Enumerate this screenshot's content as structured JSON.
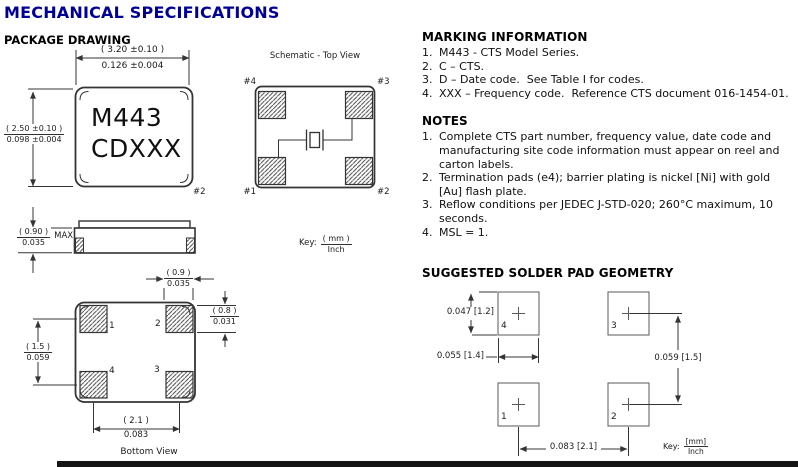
{
  "page": {
    "title": "MECHANICAL SPECIFICATIONS"
  },
  "package_drawing": {
    "heading": "PACKAGE DRAWING",
    "top_view": {
      "width_mm": "( 3.20 ±0.10 )",
      "width_in": "0.126 ±0.004",
      "height_mm": "( 2.50 ±0.10 )",
      "height_in": "0.098 ±0.004",
      "marking_line1": "M443",
      "marking_line2": "CDXXX",
      "pin2": "#2"
    },
    "side_view": {
      "height_mm": "( 0.90 )",
      "height_in": "0.035",
      "qualifier": "MAX"
    },
    "bottom_view": {
      "label": "Bottom View",
      "pad_width_mm": "( 0.9 )",
      "pad_width_in": "0.035",
      "pad_height_mm": "( 0.8 )",
      "pad_height_in": "0.031",
      "row_pitch_mm": "( 1.5 )",
      "row_pitch_in": "0.059",
      "col_pitch_mm": "( 2.1 )",
      "col_pitch_in": "0.083",
      "pad1": "1",
      "pad2": "2",
      "pad3": "3",
      "pad4": "4"
    },
    "schematic": {
      "title": "Schematic - Top View",
      "pin1": "#1",
      "pin2": "#2",
      "pin3": "#3",
      "pin4": "#4",
      "key_label": "Key:",
      "key_top": "( mm )",
      "key_bottom": "Inch"
    }
  },
  "marking_information": {
    "heading": "MARKING INFORMATION",
    "items": [
      {
        "num": "1.",
        "text": "M443 - CTS Model Series."
      },
      {
        "num": "2.",
        "text": "C – CTS."
      },
      {
        "num": "3.",
        "text": "D – Date code.  See Table I for codes."
      },
      {
        "num": "4.",
        "text": "XXX – Frequency code.  Reference CTS document 016-1454-01."
      }
    ]
  },
  "notes": {
    "heading": "NOTES",
    "items": [
      {
        "num": "1.",
        "line1": "Complete CTS part number, frequency value, date code and",
        "line2": "manufacturing site code information must appear on reel and",
        "line3": "carton labels."
      },
      {
        "num": "2.",
        "line1": "Termination pads (e4); barrier plating is nickel [Ni] with gold",
        "line2": "[Au] flash plate."
      },
      {
        "num": "3.",
        "line1": "Reflow conditions per JEDEC J-STD-020; 260°C maximum, 10",
        "line2": "seconds."
      },
      {
        "num": "4.",
        "line1": "MSL = 1."
      }
    ]
  },
  "solder_pad": {
    "heading": "SUGGESTED SOLDER PAD GEOMETRY",
    "pad_height": "0.047 [1.2]",
    "pad_width": "0.055 [1.4]",
    "row_pitch": "0.059 [1.5]",
    "col_pitch": "0.083 [2.1]",
    "pad1": "1",
    "pad2": "2",
    "pad3": "3",
    "pad4": "4",
    "key_label": "Key:",
    "key_top": "[mm]",
    "key_bottom": "Inch"
  }
}
